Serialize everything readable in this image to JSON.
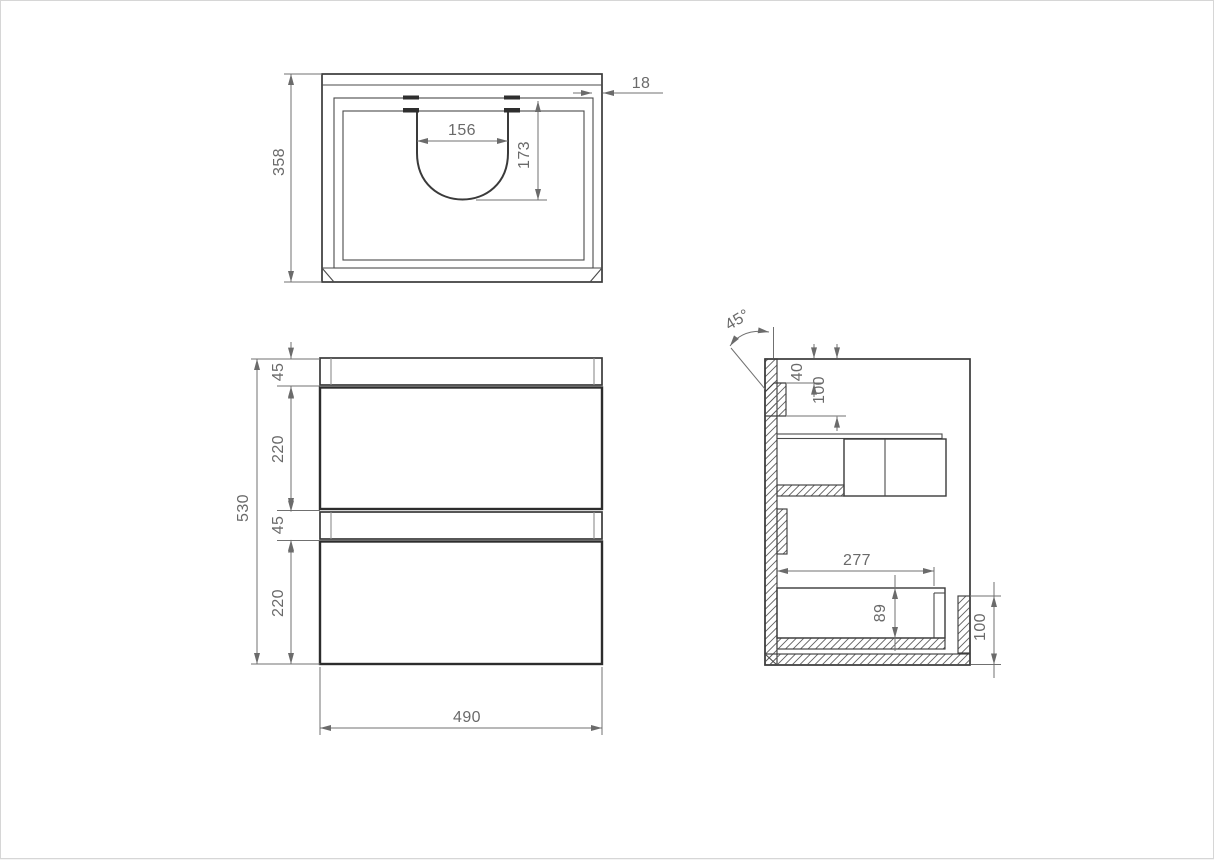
{
  "colors": {
    "background": "#ffffff",
    "object_line": "#3a3a3a",
    "dimension_line": "#707070",
    "dimension_text": "#6a6a6a"
  },
  "views": {
    "top": {
      "dims": {
        "height": "358",
        "panel_thickness": "18",
        "cutout_width": "156",
        "cutout_depth": "173"
      }
    },
    "front": {
      "dims": {
        "overall_height": "530",
        "top_rail": "45",
        "drawer_top": "220",
        "mid_rail": "45",
        "drawer_bottom": "220",
        "width": "490"
      }
    },
    "side": {
      "dims": {
        "bevel_angle": "45°",
        "rail_top_offset": "40",
        "rail_bottom_offset": "100",
        "drawer_depth": "277",
        "drawer_inner_height": "89",
        "plinth_height": "100"
      }
    }
  }
}
